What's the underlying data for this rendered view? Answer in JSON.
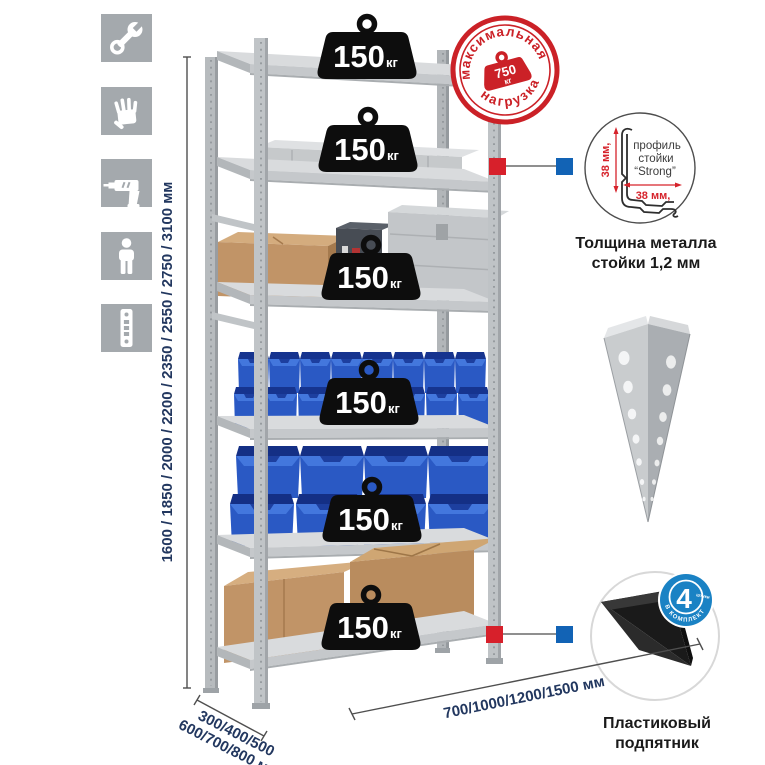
{
  "icons": [
    {
      "name": "wrench-icon"
    },
    {
      "name": "gloves-icon"
    },
    {
      "name": "drill-icon"
    },
    {
      "name": "person-icon"
    },
    {
      "name": "perforated-profile-icon"
    }
  ],
  "dims": {
    "height_text": "1600 / 1850 / 2000 / 2200 / 2350 / 2550 / 2750 / 3100 мм",
    "depth_line1": "300/400/500",
    "depth_line2": "600/700/800 мм",
    "width_text": "700/1000/1200/1500 мм"
  },
  "load": {
    "value": "150",
    "unit": "кг",
    "shelf_count": 6
  },
  "stamp": {
    "arc_top": "максимальная",
    "arc_bottom": "нагрузка",
    "value": "750",
    "unit": "кг"
  },
  "profile": {
    "line1": "профиль",
    "line2": "стойки",
    "line3": "“Strong”",
    "dim_vertical": "38 мм,",
    "dim_horizontal": "38 мм,",
    "caption_line1": "Толщина металла",
    "caption_line2": "стойки 1,2 мм"
  },
  "foot": {
    "caption_line1": "Пластиковый",
    "caption_line2": "подпятник",
    "badge_count": "4",
    "badge_count_unit": "штуки",
    "badge_arc": "в комплекте"
  },
  "colors": {
    "stamp_red": "#cb2127",
    "marker_red": "#d7202b",
    "marker_blue": "#1263b5",
    "badge_blue": "#1a82c4",
    "dim_navy": "#22375f",
    "bin_blue": "#2a59c4",
    "icon_gray": "#a4a9ad"
  }
}
